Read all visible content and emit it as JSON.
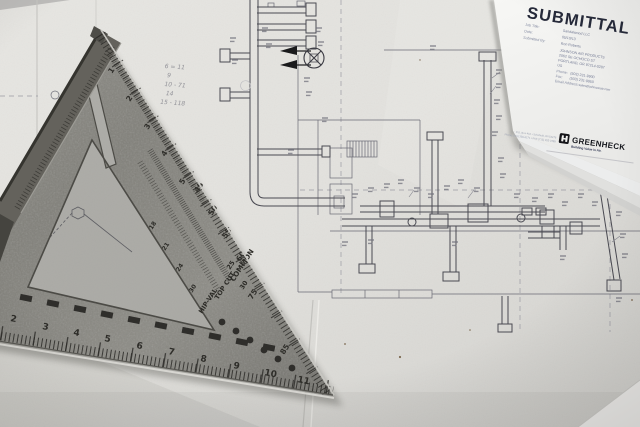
{
  "submittal": {
    "title": "SUBMITTAL",
    "fields": {
      "job_title_label": "Job Title:",
      "job_title_value": "Sandalwood LLC",
      "date_label": "Date:",
      "date_value": "05/10/13",
      "submitted_label": "Submitted By:",
      "submitted_value": "Ron Roberts",
      "company_line1": "JOHNSON AIR PRODUCTS",
      "company_line2": "2062 SE OCHOCO ST",
      "company_line3": "PORTLAND, OR 97214-0287",
      "company_line4": "US",
      "phone_label": "Phone:",
      "phone_value": "(503) 231-9900",
      "fax_label": "Fax:",
      "fax_value": "(503) 231-9950",
      "email_label": "Email Address:",
      "email_value": "sales@johnsonair.com"
    },
    "brand": {
      "name": "GREENHECK",
      "tagline": "Building Value in Air.",
      "address": "P.O. Box 410 • Schofield, WI 54476",
      "phone": "Phone (715) 359-6171 • FAX (715) 355-2399"
    }
  },
  "speed_square": {
    "bottom_ruler_numbers": [
      "2",
      "3",
      "4",
      "5",
      "6",
      "7",
      "8",
      "9",
      "10",
      "11"
    ],
    "edge_ruler_numbers": [
      "1",
      "2",
      "3",
      "4",
      "5"
    ],
    "degree_numbers": [
      "45",
      "50",
      "55",
      "60",
      "75",
      "85"
    ],
    "scales": {
      "common": "COMMON",
      "top_cut": "TOP CUT",
      "hip_val": "HIP-VAL",
      "common_number_a": "25",
      "common_number_b": "30",
      "inner_numbers": [
        "18",
        "21",
        "24",
        "30"
      ]
    }
  },
  "blueprint": {
    "handwritten_notes": [
      "6 = 11",
      "9",
      "10 - 71",
      "14",
      "15 - 118"
    ]
  },
  "colors": {
    "paper": "#e2e1dd",
    "metal_gray": "#86857f",
    "title_navy": "#262a3a",
    "brand_black": "#15171c",
    "drawing_line": "#5d5d67"
  }
}
